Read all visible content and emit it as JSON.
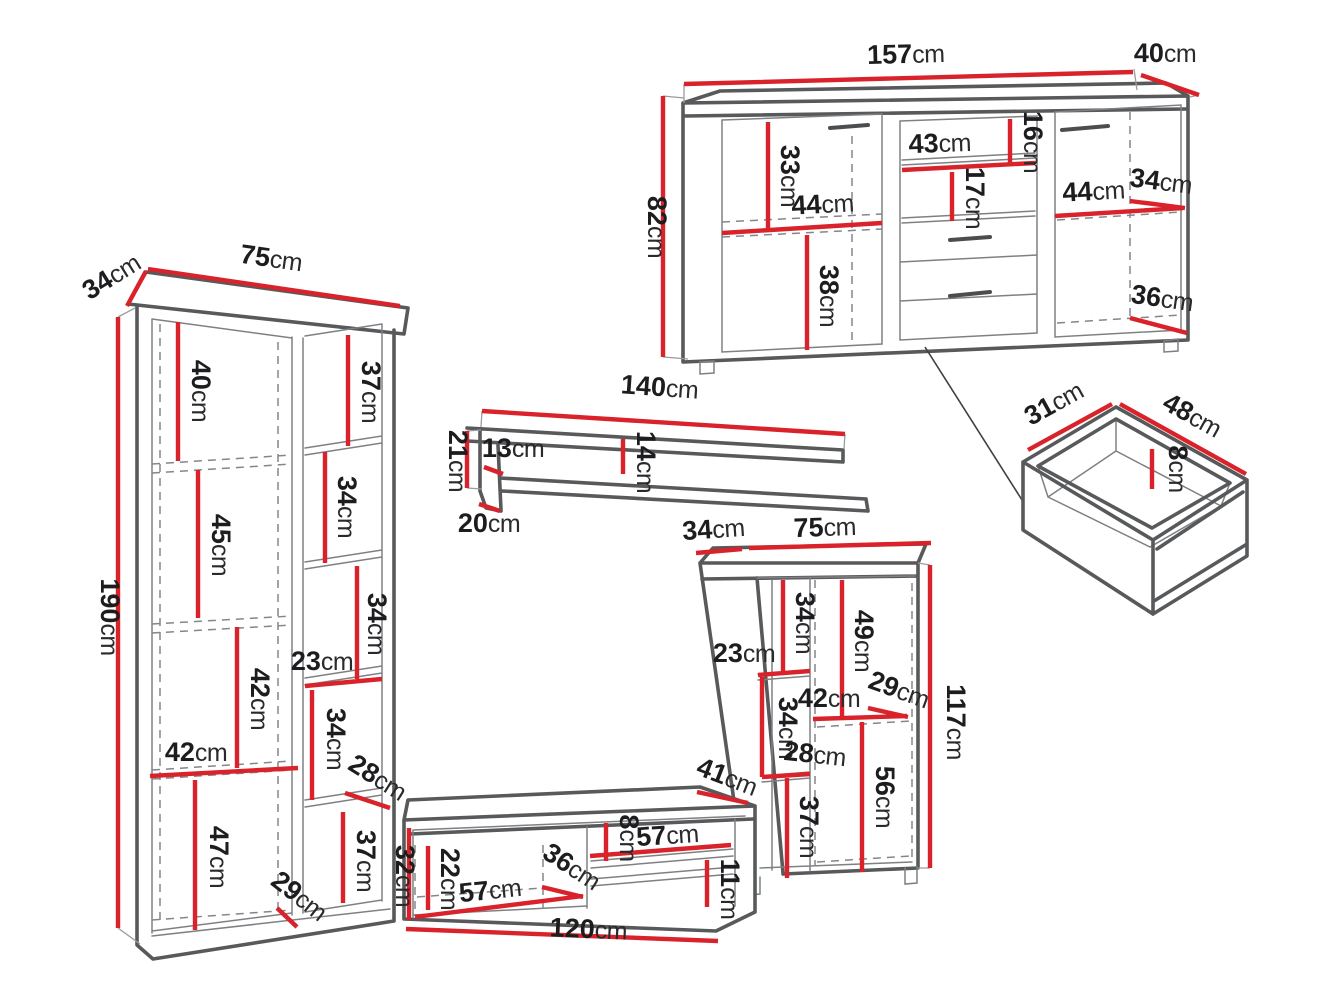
{
  "unit": "cm",
  "pieces": {
    "sideboard": {
      "name": "sideboard",
      "dims": {
        "width_top": "157",
        "depth_top": "40",
        "height_left": "82",
        "left_upper": "33",
        "left_shelf_width": "44",
        "left_lower": "38",
        "middle_shelf_width": "43",
        "middle_top_gap": "16",
        "middle_shelf_gap": "17",
        "right_shelf_width": "44",
        "right_depth": "34",
        "right_bottom_depth": "36"
      }
    },
    "bookcase": {
      "name": "tall bookcase",
      "dims": {
        "depth_top": "34",
        "width_top": "75",
        "height_left": "190",
        "cell_1": "40",
        "cell_2": "45",
        "cell_3": "42",
        "shelf_width": "42",
        "cell_4": "47",
        "base_depth": "29",
        "side_cell_1": "37",
        "side_cell_2": "34",
        "side_cell_3": "34",
        "side_width": "23",
        "side_cell_4": "34",
        "side_shelf_depth": "28",
        "side_cell_5": "37"
      }
    },
    "wall_shelf": {
      "name": "wall shelf",
      "dims": {
        "width_top": "140",
        "height_left": "21",
        "side_height": "13",
        "board_gap": "14",
        "depth_bottom": "20"
      }
    },
    "tv_stand": {
      "name": "tv stand",
      "dims": {
        "depth_top_right": "41",
        "height_left": "32",
        "inner_height": "22",
        "door_width": "57",
        "door_depth": "36",
        "top_gap": "8",
        "shelf_width": "57",
        "bottom_gap": "11",
        "width_bottom": "120"
      }
    },
    "cabinet": {
      "name": "display cabinet",
      "dims": {
        "depth_top": "34",
        "width_top": "75",
        "height_right": "117",
        "cell_1": "34",
        "inner_width": "23",
        "cell_2": "49",
        "shelf_depth": "29",
        "shelf_width": "42",
        "cell_3": "34",
        "lower_shelf_depth": "28",
        "cell_4": "37",
        "cell_5": "56"
      }
    },
    "drawer": {
      "name": "drawer box",
      "dims": {
        "depth_top": "31",
        "width_top": "48",
        "inner_height": "8"
      }
    }
  }
}
